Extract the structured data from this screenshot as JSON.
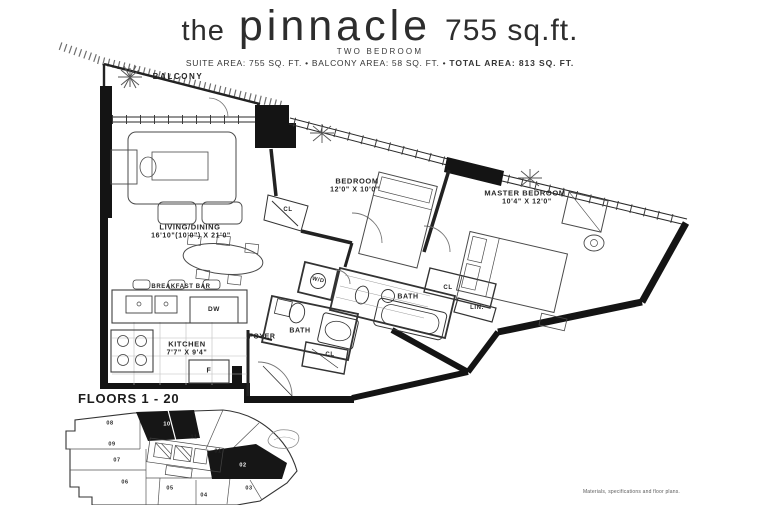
{
  "header": {
    "title_article": "the",
    "title_name": "pinnacle",
    "title_area": "755 sq.ft.",
    "subtitle": "TWO BEDROOM",
    "areas_line": "SUITE AREA: 755 SQ. FT.  •  BALCONY AREA: 58 SQ. FT.  •",
    "areas_total": "TOTAL AREA: 813 SQ. FT."
  },
  "colors": {
    "ink": "#1c1c1c",
    "wall": "#141414",
    "furniture": "#4a4a4a"
  },
  "floorplan": {
    "balcony": {
      "name": "BALCONY"
    },
    "living": {
      "name": "LIVING/DINING",
      "dims": "16'10\"(10'0\") X 21'0\""
    },
    "bedroom": {
      "name": "BEDROOM",
      "dims": "12'0\" X 10'0\""
    },
    "master": {
      "name": "MASTER BEDROOM",
      "dims": "10'4\" X 12'0\""
    },
    "kitchen": {
      "name": "KITCHEN",
      "dims": "7'7\" X 9'4\""
    },
    "breakfast_bar": "BREAKFAST BAR",
    "foyer": "FOYER",
    "bath_main": "BATH",
    "bath_ensuite": "BATH",
    "washer_dryer": "W/D",
    "dishwasher": "DW",
    "fridge": "F",
    "closet_bedroom": "CL",
    "closet_foyer": "CL",
    "closet_master": "CL",
    "linen": "LIN."
  },
  "keyplan": {
    "heading": "FLOORS 1 - 20",
    "highlighted_units": [
      "10",
      "02"
    ],
    "units": {
      "u01": "01",
      "u02": "02",
      "u03": "03",
      "u04": "04",
      "u05": "05",
      "u06": "06",
      "u07": "07",
      "u08": "08",
      "u09": "09",
      "u10": "10",
      "u11": "11"
    }
  },
  "footer": {
    "disclaimer": "Materials, specifications and floor plans."
  }
}
